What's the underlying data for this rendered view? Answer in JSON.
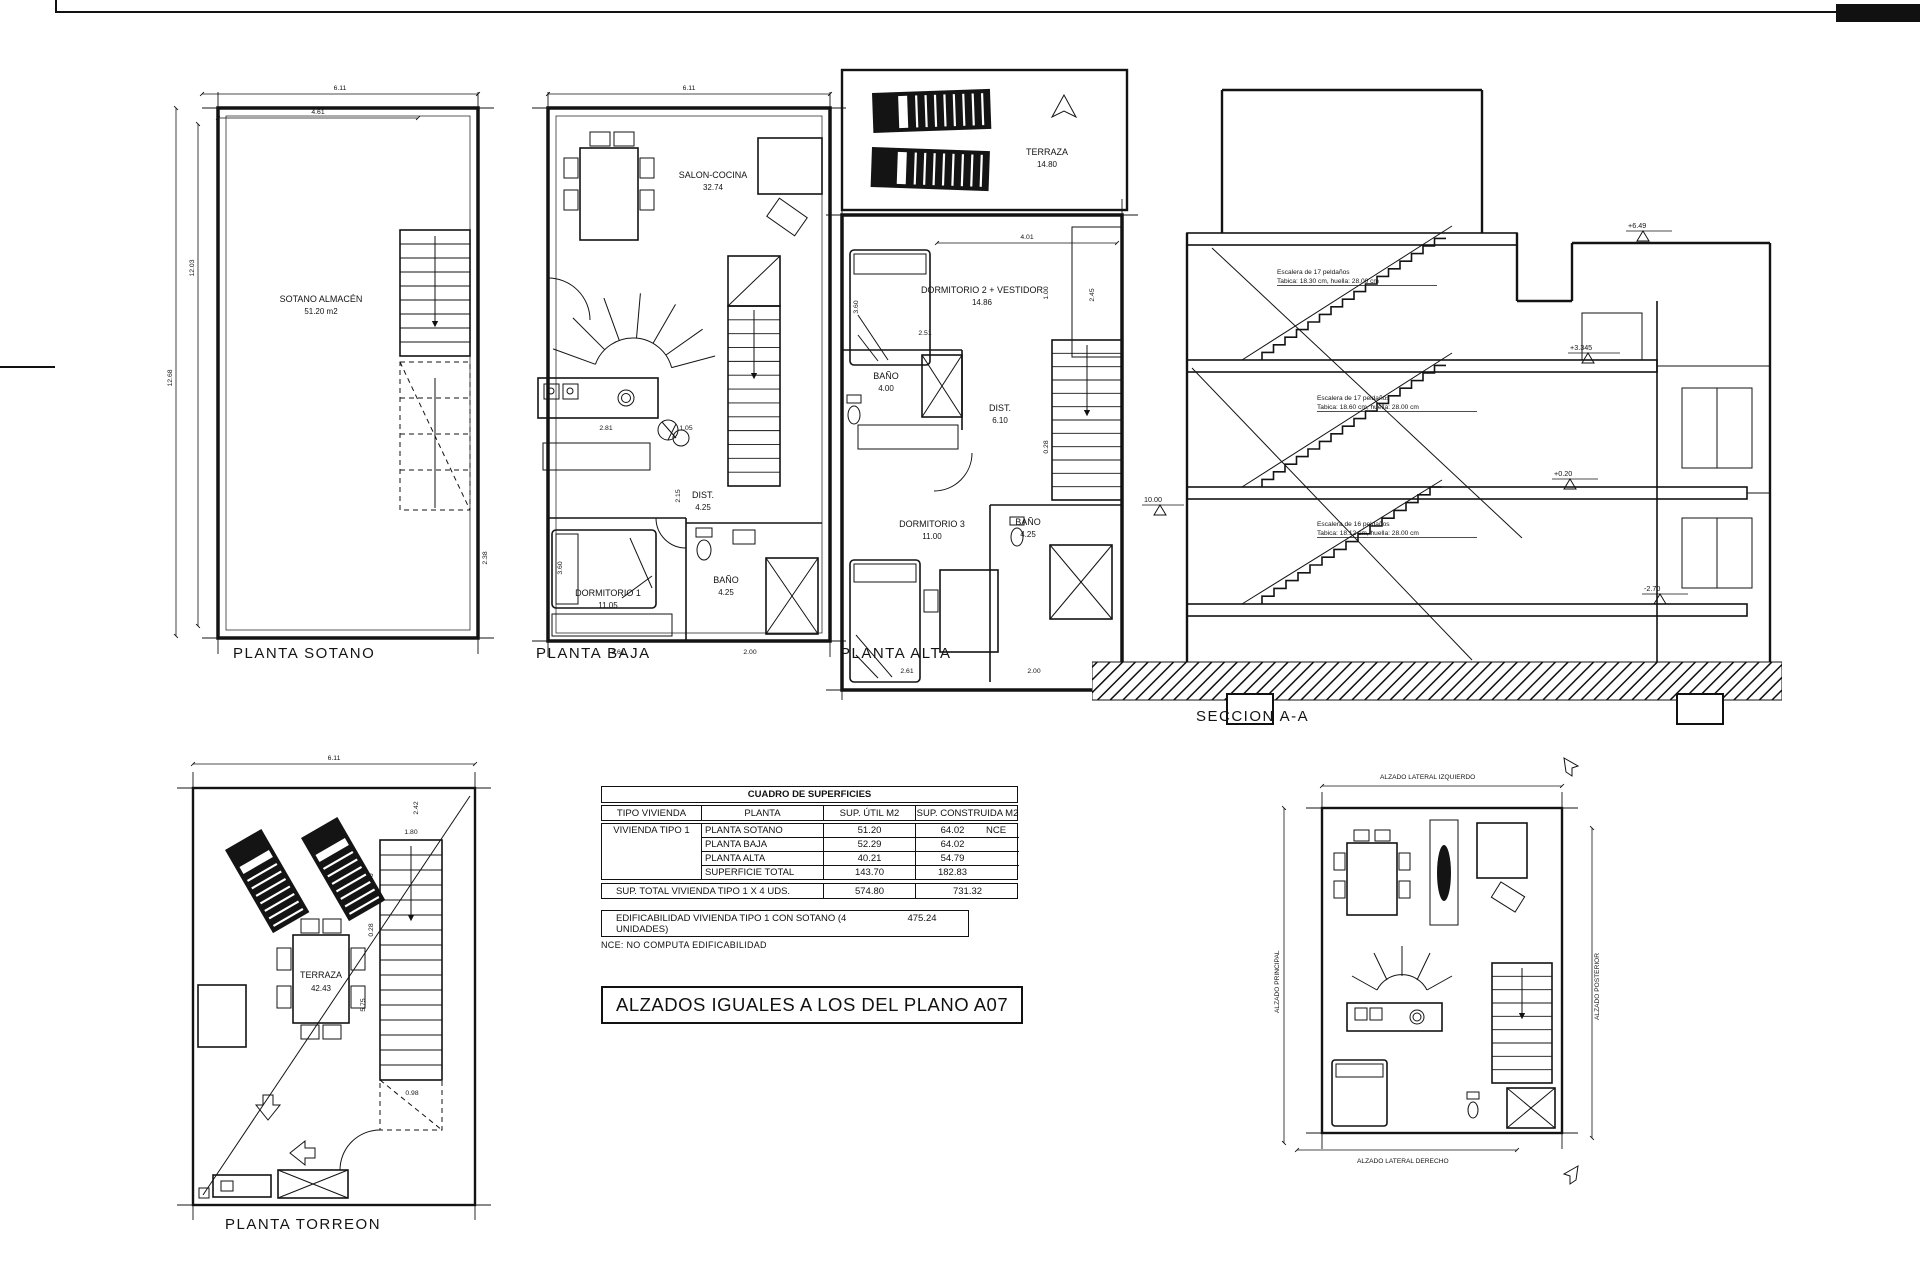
{
  "titles": {
    "sotano": "PLANTA SOTANO",
    "baja": "PLANTA BAJA",
    "alta": "PLANTA ALTA",
    "seccion": "SECCION A-A",
    "torreon": "PLANTA TORREON"
  },
  "sotano": {
    "room": "SOTANO ALMACÉN",
    "area": "51.20 m2",
    "dims": {
      "top": "6.11",
      "top_inner": "4.61",
      "left": "12.68",
      "left_inner": "12.03",
      "right": "2.38"
    }
  },
  "baja": {
    "salon": "SALON-COCINA",
    "salon_area": "32.74",
    "dorm1": "DORMITORIO 1",
    "dorm1_area": "11.05",
    "bano": "BAÑO",
    "bano_area": "4.25",
    "dist": "DIST.",
    "dist_area": "4.25",
    "dims": {
      "top": "6.11",
      "w1": "2.81",
      "w2": "1.05",
      "w3": "3.61",
      "w4": "2.00",
      "h1": "3.60",
      "h2": "2.15"
    }
  },
  "alta": {
    "terraza": "TERRAZA",
    "terraza_area": "14.80",
    "dorm2": "DORMITORIO 2 + VESTIDOR",
    "dorm2_area": "14.86",
    "bano1": "BAÑO",
    "bano1_area": "4.00",
    "dist": "DIST.",
    "dist_area": "6.10",
    "dorm3": "DORMITORIO 3",
    "dorm3_area": "11.00",
    "bano2": "BAÑO",
    "bano2_area": "4.25",
    "dims": {
      "w1": "4.01",
      "w2": "2.51",
      "w3": "2.61",
      "w4": "2.00",
      "h1": "3.60",
      "h2": "2.45",
      "h3": "1.00",
      "h4": "0.28"
    }
  },
  "seccion": {
    "stairs": [
      {
        "l1": "Escalera de 17 peldaños",
        "l2": "Tabica: 18.30 cm, huella: 28.00 cm"
      },
      {
        "l1": "Escalera de 17 peldaños",
        "l2": "Tabica: 18.60 cm, huella: 28.00 cm"
      },
      {
        "l1": "Escalera de 16 peldaños",
        "l2": "Tabica: 18.12 cm, huella: 28.00 cm"
      }
    ],
    "levels": {
      "torreon": "+6.49",
      "alta": "+3.345",
      "baja": "+0.20",
      "sotano": "-2.70"
    },
    "dim_height": "10.00"
  },
  "torreon": {
    "terraza": "TERRAZA",
    "terraza_area": "42.43",
    "dims": {
      "top": "6.11",
      "d1": "2.42",
      "d2": "1.80",
      "d3": "1.00",
      "d4": "0.28",
      "d5": "5.75",
      "d6": "0.98"
    }
  },
  "elevplan": {
    "top": "ALZADO LATERAL IZQUIERDO",
    "bottom": "ALZADO LATERAL DERECHO",
    "left": "ALZADO PRINCIPAL",
    "right": "ALZADO POSTERIOR"
  },
  "table": {
    "title": "CUADRO DE SUPERFICIES",
    "col_tipo": "TIPO VIVIENDA",
    "col_planta": "PLANTA",
    "col_util": "SUP. ÚTIL M2",
    "col_cons": "SUP. CONSTRUIDA M2",
    "tipo": "VIVIENDA TIPO 1",
    "rows": [
      {
        "planta": "PLANTA SOTANO",
        "util": "51.20",
        "cons": "64.02",
        "note": "NCE"
      },
      {
        "planta": "PLANTA BAJA",
        "util": "52.29",
        "cons": "64.02",
        "note": ""
      },
      {
        "planta": "PLANTA ALTA",
        "util": "40.21",
        "cons": "54.79",
        "note": ""
      },
      {
        "planta": "SUPERFICIE TOTAL",
        "util": "143.70",
        "cons": "182.83",
        "note": ""
      }
    ],
    "total_label": "SUP. TOTAL VIVIENDA TIPO 1 X 4 UDS.",
    "total_util": "574.80",
    "total_cons": "731.32",
    "edif_label": "EDIFICABILIDAD VIVIENDA TIPO 1 CON SOTANO (4 UNIDADES)",
    "edif_value": "475.24"
  },
  "notes": {
    "nce": "NCE:  NO COMPUTA EDIFICABILIDAD",
    "alzados": "ALZADOS IGUALES A LOS DEL PLANO A07"
  }
}
